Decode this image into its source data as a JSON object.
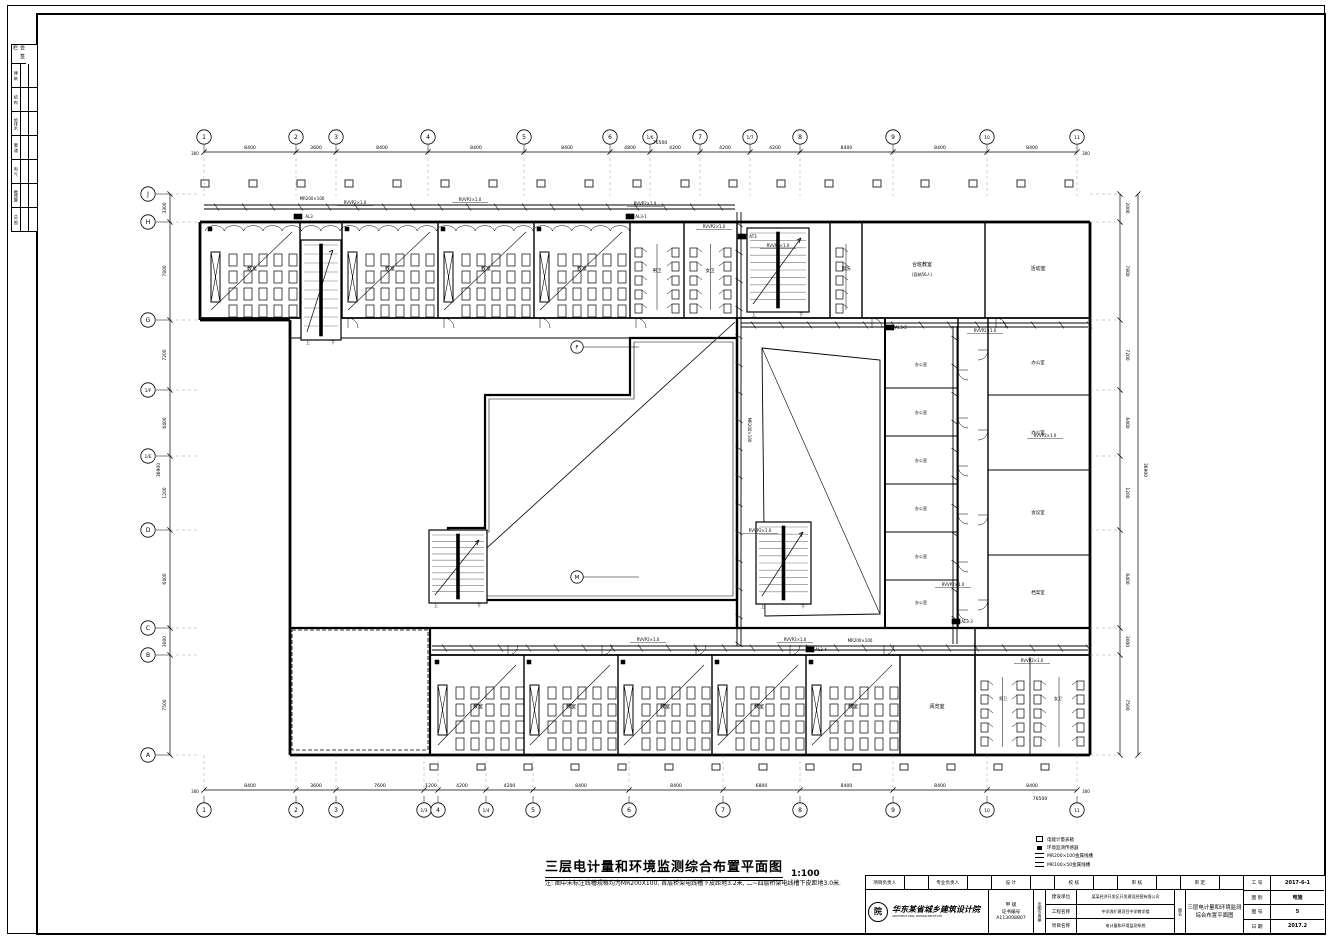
{
  "plan": {
    "title": "三层电计量和环境监测综合布置平面图",
    "scale": "1:100",
    "note": "注: 图中未标注线槽规格均为MR200X100, 首层桥架电线槽下皮距地3.2米, 二~四层桥架电线槽下皮距地3.0米.",
    "stair_up": "上",
    "stair_down": "下",
    "axes": {
      "top": {
        "xs": [
          204,
          296,
          336,
          428,
          524,
          610,
          650,
          700,
          750,
          800,
          893,
          987,
          1077
        ],
        "labels": [
          "1",
          "2",
          "3",
          "4",
          "5",
          "6",
          "1/6",
          "7",
          "1/7",
          "8",
          "9",
          "10",
          "11"
        ],
        "dims": [
          "8400",
          "3600",
          "8400",
          "8400",
          "8400",
          "4800",
          "4200",
          "4200",
          "4200",
          "8400",
          "8400",
          "8400"
        ],
        "edge": "300",
        "total": "76500"
      },
      "bottom": {
        "xs": [
          204,
          296,
          336,
          424,
          438,
          486,
          533,
          629,
          723,
          800,
          893,
          987,
          1077
        ],
        "labels": [
          "1",
          "2",
          "3",
          "1/3",
          "4",
          "1/4",
          "5",
          "6",
          "7",
          "8",
          "9",
          "10",
          "11"
        ],
        "dims": [
          "8400",
          "3600",
          "7600",
          "1200",
          "4200",
          "4200",
          "8400",
          "8400",
          "6800",
          "8400",
          "8400",
          "8400"
        ],
        "edge": "300",
        "total": "76500"
      },
      "left": {
        "ys": [
          194,
          222,
          320,
          390,
          456,
          530,
          628,
          655,
          755
        ],
        "labels": [
          "J",
          "H",
          "G",
          "1/F",
          "1/E",
          "D",
          "C",
          "B",
          "A"
        ],
        "dims": [
          "3300",
          "7800",
          "7200",
          "6400",
          "1200",
          "6400",
          "3000",
          "7500"
        ],
        "total": "36900"
      },
      "right": {
        "ys": [
          194,
          222,
          320,
          390,
          456,
          530,
          628,
          655,
          755
        ],
        "dims": [
          "2000",
          "7800",
          "7200",
          "6400",
          "1200",
          "6400",
          "3000",
          "7500"
        ],
        "total": "36900"
      }
    },
    "inner_bubbles": [
      {
        "x": 577,
        "y": 347,
        "t": "F"
      },
      {
        "x": 577,
        "y": 577,
        "t": "M"
      }
    ],
    "rooms": [
      {
        "x": 252,
        "y": 270,
        "t": "教室",
        "s": 5
      },
      {
        "x": 390,
        "y": 270,
        "t": "教室",
        "s": 5
      },
      {
        "x": 486,
        "y": 270,
        "t": "教室",
        "s": 5
      },
      {
        "x": 582,
        "y": 270,
        "t": "教室",
        "s": 5
      },
      {
        "x": 657,
        "y": 272,
        "t": "男卫",
        "s": 4.5
      },
      {
        "x": 710,
        "y": 272,
        "t": "女卫",
        "s": 4.5
      },
      {
        "x": 846,
        "y": 270,
        "t": "盥洗",
        "s": 4.5
      },
      {
        "x": 922,
        "y": 266,
        "t": "合班教室",
        "s": 5
      },
      {
        "x": 922,
        "y": 276,
        "t": "(容纳56人)",
        "s": 4
      },
      {
        "x": 1038,
        "y": 270,
        "t": "活动室",
        "s": 5
      },
      {
        "x": 921,
        "y": 366,
        "t": "办公室",
        "s": 4
      },
      {
        "x": 921,
        "y": 414,
        "t": "办公室",
        "s": 4
      },
      {
        "x": 921,
        "y": 462,
        "t": "办公室",
        "s": 4
      },
      {
        "x": 921,
        "y": 510,
        "t": "办公室",
        "s": 4
      },
      {
        "x": 921,
        "y": 558,
        "t": "办公室",
        "s": 4
      },
      {
        "x": 921,
        "y": 604,
        "t": "办公室",
        "s": 4
      },
      {
        "x": 1038,
        "y": 364,
        "t": "办公室",
        "s": 4.5
      },
      {
        "x": 1038,
        "y": 434,
        "t": "办公室",
        "s": 4.5
      },
      {
        "x": 1038,
        "y": 514,
        "t": "会议室",
        "s": 4.5
      },
      {
        "x": 1038,
        "y": 594,
        "t": "档案室",
        "s": 4.5
      },
      {
        "x": 478,
        "y": 708,
        "t": "教室",
        "s": 5
      },
      {
        "x": 571,
        "y": 708,
        "t": "教室",
        "s": 5
      },
      {
        "x": 665,
        "y": 708,
        "t": "教室",
        "s": 5
      },
      {
        "x": 759,
        "y": 708,
        "t": "教室",
        "s": 5
      },
      {
        "x": 853,
        "y": 708,
        "t": "教室",
        "s": 5
      },
      {
        "x": 937,
        "y": 708,
        "t": "阅览室",
        "s": 5
      },
      {
        "x": 1003,
        "y": 700,
        "t": "男卫",
        "s": 4
      },
      {
        "x": 1058,
        "y": 700,
        "t": "女卫",
        "s": 4
      }
    ],
    "cables": [
      {
        "x": 355,
        "y": 204,
        "t": "RVVP2×1.0"
      },
      {
        "x": 470,
        "y": 201,
        "t": "RVVP2×1.0"
      },
      {
        "x": 645,
        "y": 205,
        "t": "RVVP2×1.0"
      },
      {
        "x": 714,
        "y": 228,
        "t": "RVVP2×1.0"
      },
      {
        "x": 778,
        "y": 247,
        "t": "RVVP2×1.0"
      },
      {
        "x": 985,
        "y": 332,
        "t": "RVVP2×1.0"
      },
      {
        "x": 1045,
        "y": 437,
        "t": "RVVP2×1.0"
      },
      {
        "x": 953,
        "y": 586,
        "t": "RVVP2×1.0"
      },
      {
        "x": 648,
        "y": 641,
        "t": "RVVP2×1.0"
      },
      {
        "x": 795,
        "y": 641,
        "t": "RVVP2×1.0"
      },
      {
        "x": 1032,
        "y": 662,
        "t": "RVVP2×1.0"
      },
      {
        "x": 760,
        "y": 532,
        "t": "RVVP2×1.0"
      }
    ],
    "trays_labels": [
      {
        "x": 312,
        "y": 200,
        "t": "MR200×100",
        "rot": 0
      },
      {
        "x": 748,
        "y": 430,
        "t": "MR200×100",
        "rot": 90
      },
      {
        "x": 860,
        "y": 642,
        "t": "MR200×100",
        "rot": 0
      }
    ],
    "panels": [
      {
        "x": 298,
        "y": 217,
        "t": "AL3"
      },
      {
        "x": 630,
        "y": 217,
        "t": "AL3-1"
      },
      {
        "x": 742,
        "y": 237,
        "t": "AT3"
      },
      {
        "x": 890,
        "y": 328,
        "t": "AL3-2"
      },
      {
        "x": 956,
        "y": 622,
        "t": "AL3-3"
      },
      {
        "x": 810,
        "y": 650,
        "t": "AL3-4"
      }
    ],
    "legend": [
      {
        "sym": "sq",
        "t": "电能计量表箱"
      },
      {
        "sym": "fsq",
        "t": "环境监测传感器"
      },
      {
        "sym": "dl",
        "t": "MR200×100金属线槽"
      },
      {
        "sym": "dl",
        "t": "MR100×50金属线槽"
      }
    ]
  },
  "sigstrip": {
    "header": "会 签 栏",
    "rows": [
      "建 筑",
      "结 构",
      "给排水",
      "暖 通",
      "电 气",
      "概预算",
      "总 图"
    ]
  },
  "titleblock": {
    "sig_cells": [
      "项目负责人",
      "",
      "专业负责人",
      "",
      "设 计",
      "",
      "校 核",
      "",
      "审 核",
      "",
      "审 定",
      ""
    ],
    "company": {
      "name": "华东某省城乡建筑设计院",
      "en": "ARCHITECTURAL DESIGN INSTITUTE",
      "logo_char": "院",
      "grade": "甲 级",
      "cert_label": "证书编号",
      "cert_no": "A113008807",
      "stamp": "出图专用章"
    },
    "projects": [
      {
        "l": "建设单位",
        "v": "某某经济开发区开发建设经营有限公司"
      },
      {
        "l": "工程名称",
        "v": "中学改扩建项目中学教学楼"
      },
      {
        "l": "项目名称",
        "v": "电计量和环境监测系统"
      }
    ],
    "side": "图名",
    "dtitle": [
      "三层电计量和环境监测",
      "综合布置平面图"
    ],
    "meta": [
      {
        "l": "工 号",
        "v": "2017-6-1"
      },
      {
        "l": "图 别",
        "v": "电施"
      },
      {
        "l": "图 号",
        "v": "5"
      },
      {
        "l": "日 期",
        "v": "2017.2"
      }
    ]
  }
}
